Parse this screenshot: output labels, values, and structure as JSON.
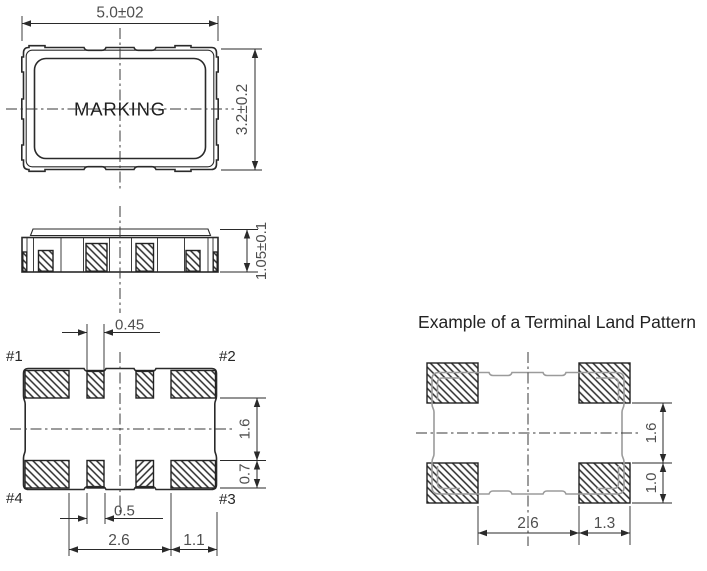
{
  "colors": {
    "line": "#2a2a2a",
    "dimension_text": "#4f4f4f",
    "land_pattern_outline": "#9b9b9b",
    "background": "#ffffff"
  },
  "top_view": {
    "marking_label": "MARKING",
    "dim_width": "5.0±02",
    "dim_height": "3.2±0.2"
  },
  "side_view": {
    "dim_thickness": "1.05±0.1"
  },
  "bottom_view": {
    "pin1": "#1",
    "pin2": "#2",
    "pin3": "#3",
    "pin4": "#4",
    "dim_small_pad_width": "0.45",
    "dim_pad_row_gap": "1.6",
    "dim_pad_height": "0.7",
    "dim_small_pad_width_bottom": "0.5",
    "dim_inner_span": "2.6",
    "dim_corner_pad_width": "1.1"
  },
  "land_pattern": {
    "title": "Example of a Terminal Land Pattern",
    "dim_pad_gap": "1.6",
    "dim_pad_height": "1.0",
    "dim_inner_span": "2.6",
    "dim_pad_width": "1.3"
  }
}
